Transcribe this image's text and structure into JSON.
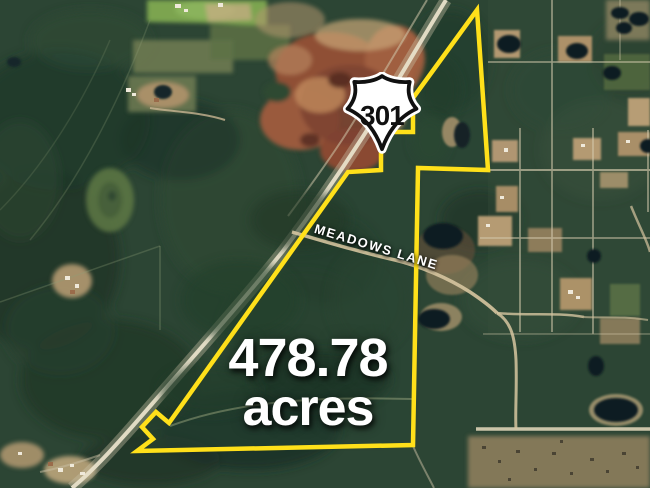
{
  "map": {
    "route_shield": "301",
    "street_label": "MEADOWS LANE",
    "acreage_value": "478.78",
    "acreage_unit": "acres",
    "colors": {
      "boundary": "#FFE01A",
      "label_text": "#FFFFFF"
    }
  }
}
